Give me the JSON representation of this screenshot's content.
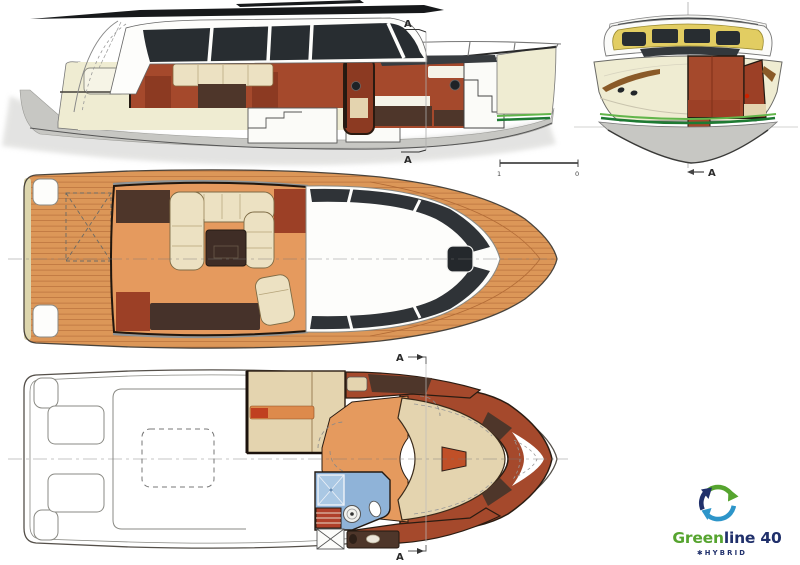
{
  "labels": {
    "side_section_top": "A",
    "side_section_bottom": "A",
    "front_section": "A",
    "lower_section_top": "A",
    "lower_section_bottom": "A"
  },
  "scale_bar": {
    "left": "1",
    "right": "0"
  },
  "logo": {
    "brand_green": "Green",
    "brand_rest": "line 40",
    "tagline_star": "✱",
    "tagline": "HYBRID"
  },
  "colors": {
    "paper": "#ffffff",
    "ink": "#1c1c1c",
    "outline": "#6a6a6a",
    "shadow": "#c9c9c6",
    "hull-cream": "#efecd2",
    "hull-grey": "#c7c7c3",
    "terracotta": "#a5492c",
    "brick-dark": "#8c3a22",
    "wall-red": "#9c4026",
    "wood-dark": "#4e362a",
    "teak": "#dc9758",
    "teak-line": "#b26b36",
    "floor-orange": "#e59a5e",
    "sofa-cream": "#ece1c2",
    "berth-beige": "#e4d4af",
    "window-dark": "#282d31",
    "frame-yellow": "#e2cd62",
    "stripe-green-dark": "#1e7a33",
    "stripe-green-light": "#62b54a",
    "bath-blue": "#8fb3d8",
    "bath-blue-light": "#aac8e4",
    "pillow-orange": "#dd8a4c",
    "pillow-red": "#c04020",
    "logo-green": "#56a42f",
    "logo-blue": "#2d95c9",
    "logo-navy": "#20306b",
    "caprail": "#8a5a28"
  }
}
